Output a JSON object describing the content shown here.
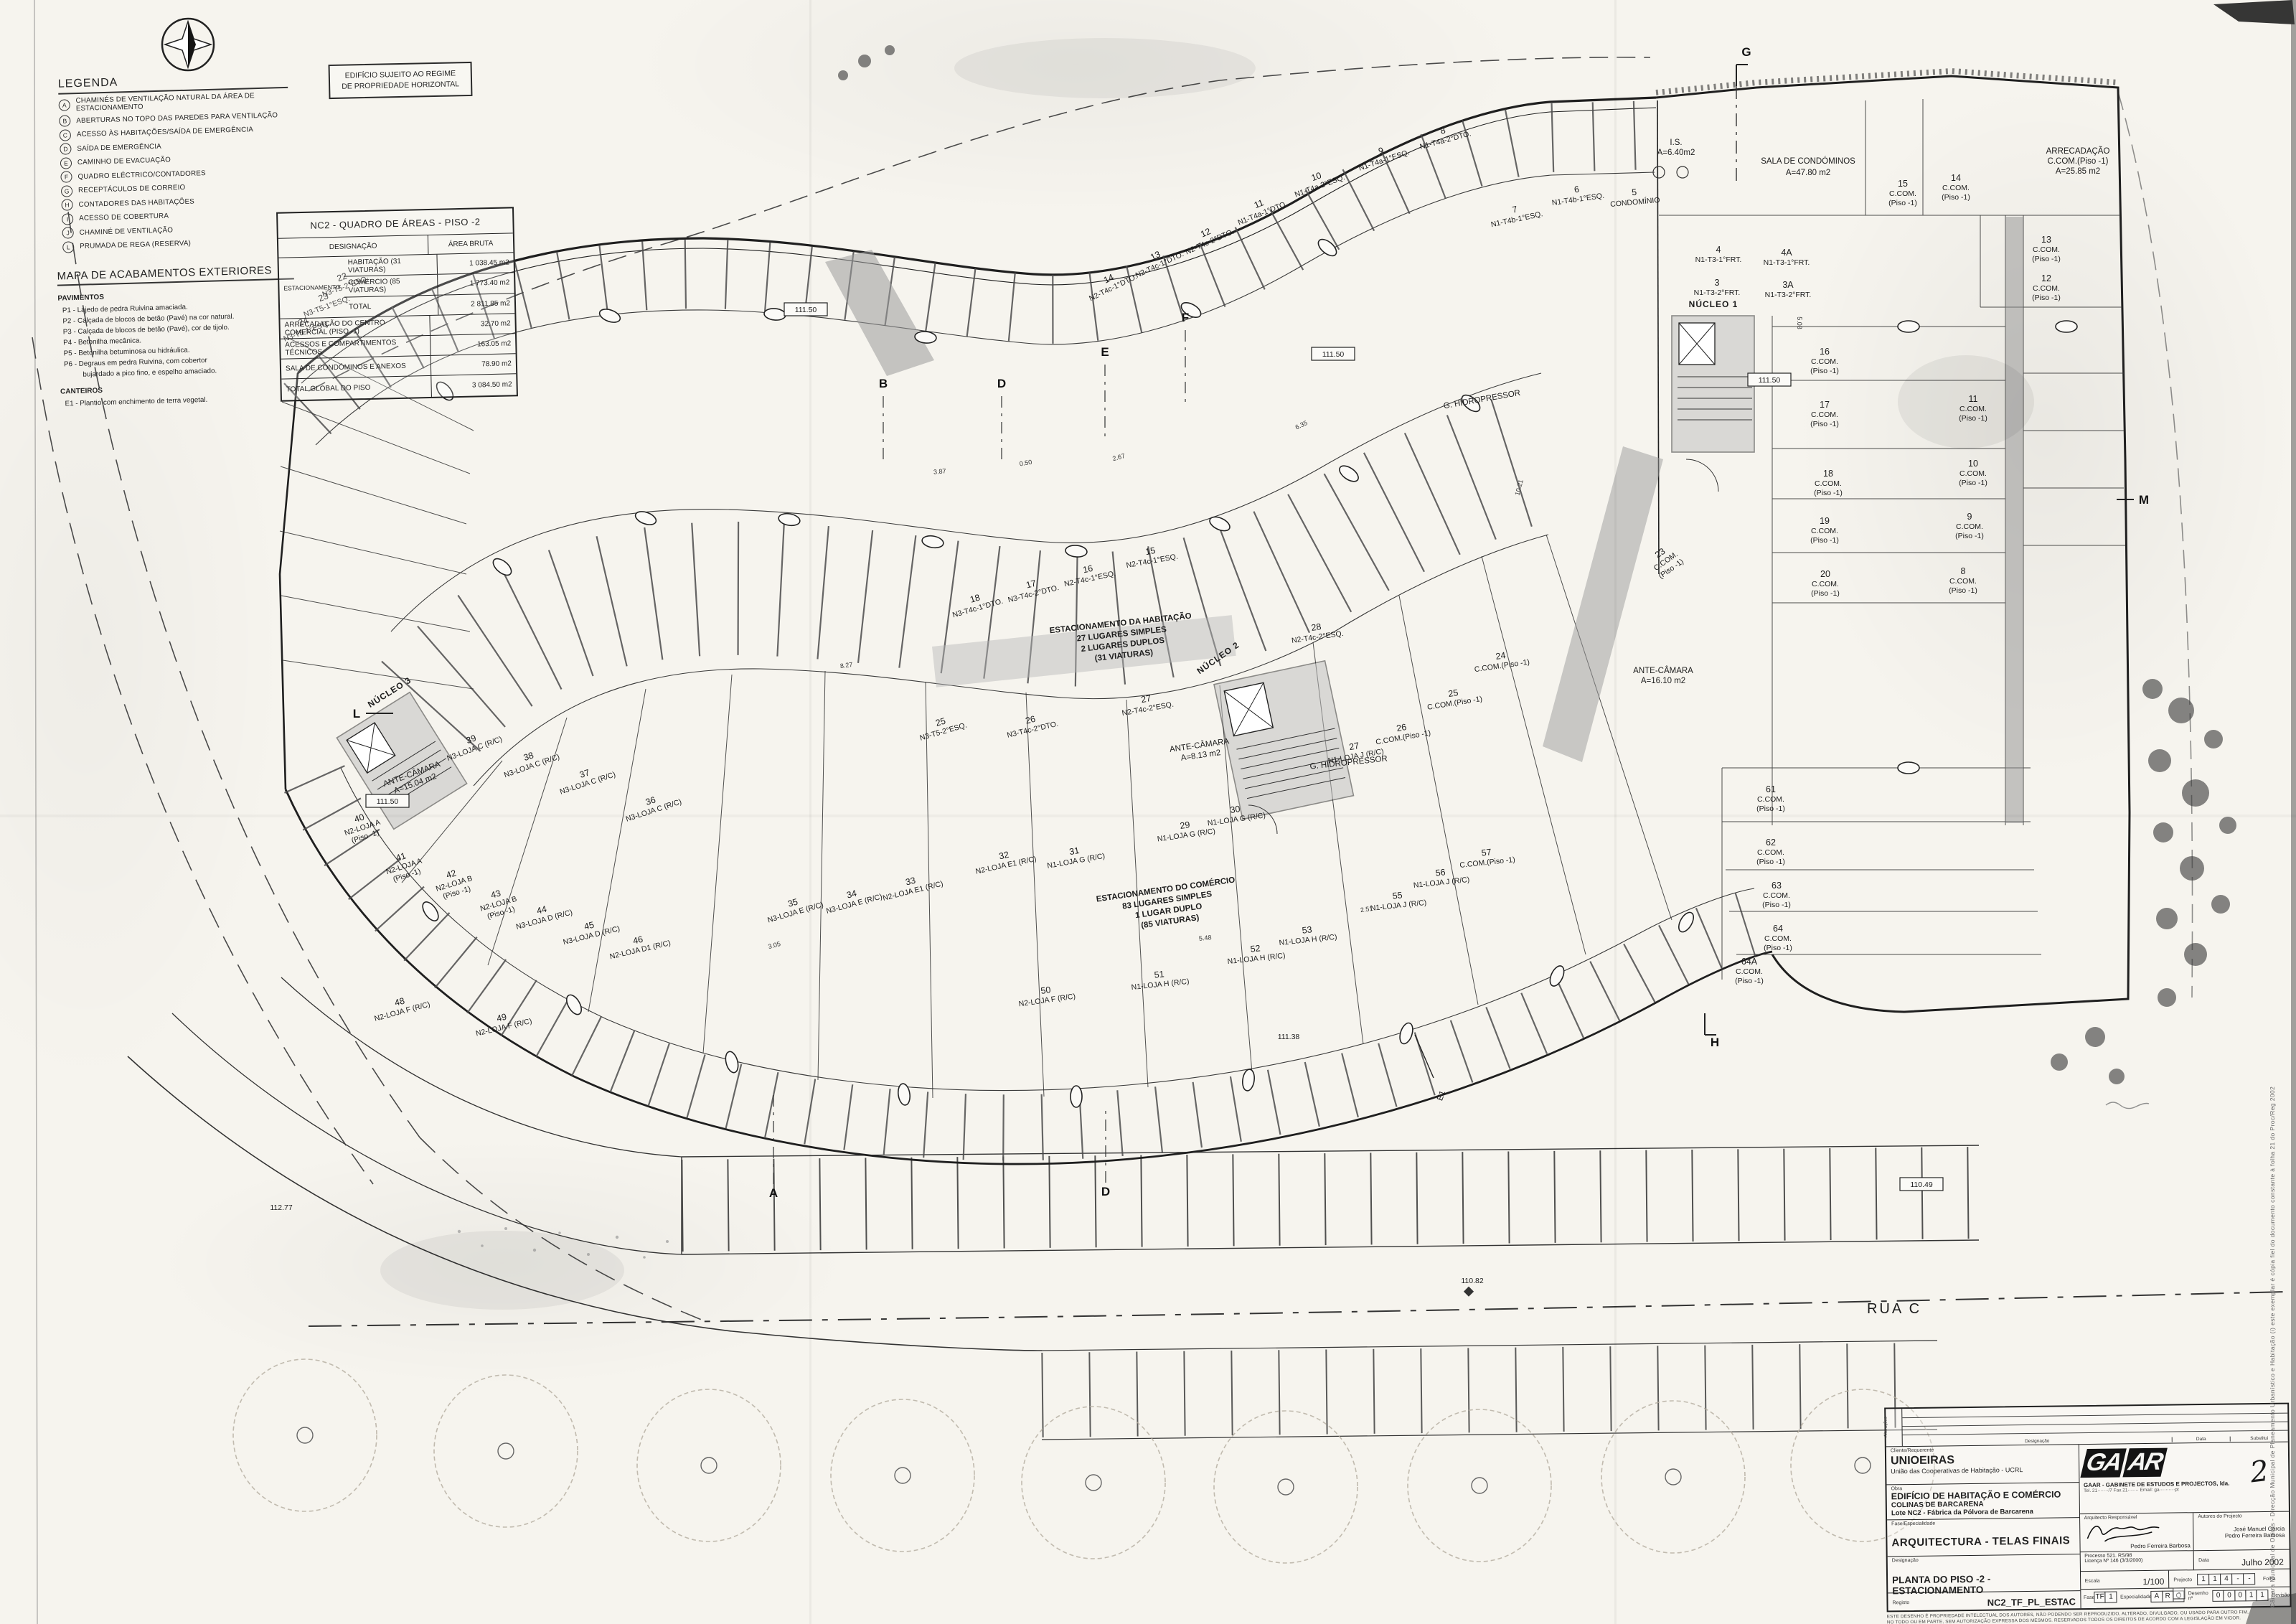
{
  "legend": {
    "title": "LEGENDA",
    "items": [
      {
        "k": "A",
        "t": "CHAMINÉS DE VENTILAÇÃO NATURAL DA ÁREA DE ESTACIONAMENTO"
      },
      {
        "k": "B",
        "t": "ABERTURAS NO TOPO DAS PAREDES PARA VENTILAÇÃO"
      },
      {
        "k": "C",
        "t": "ACESSO ÀS HABITAÇÕES/SAÍDA DE EMERGÊNCIA"
      },
      {
        "k": "D",
        "t": "SAÍDA DE EMERGÊNCIA"
      },
      {
        "k": "E",
        "t": "CAMINHO DE EVACUAÇÃO"
      },
      {
        "k": "F",
        "t": "QUADRO ELÉCTRICO/CONTADORES"
      },
      {
        "k": "G",
        "t": "RECEPTÁCULOS DE CORREIO"
      },
      {
        "k": "H",
        "t": "CONTADORES DAS HABITAÇÕES"
      },
      {
        "k": "I",
        "t": "ACESSO DE COBERTURA"
      },
      {
        "k": "J",
        "t": "CHAMINÉ DE VENTILAÇÃO"
      },
      {
        "k": "L",
        "t": "PRUMADA DE REGA (RESERVA)"
      }
    ]
  },
  "finishes": {
    "title": "MAPA DE ACABAMENTOS EXTERIORES",
    "s1": "PAVIMENTOS",
    "p": [
      "P1 - Lajedo de pedra Ruivina amaciada.",
      "P2 - Calçada de blocos de betão (Pavé) na cor natural.",
      "P3 - Calçada de blocos de betão (Pavé), cor de tijolo.",
      "P4 - Betonilha mecânica.",
      "P5 - Betonilha betuminosa ou hidráulica.",
      "P6 - Degraus em pedra Ruivina, com cobertor",
      "bujardado a pico fino, e espelho amaciado."
    ],
    "s2": "CANTEIROS",
    "c": "E1 - Plantio com enchimento de terra vegetal."
  },
  "notice": {
    "l1": "EDIFÍCIO SUJEITO AO REGIME",
    "l2": "DE PROPRIEDADE HORIZONTAL"
  },
  "areas": {
    "title": "NC2 - QUADRO DE ÁREAS - PISO -2",
    "h1": "DESIGNAÇÃO",
    "h2": "ÁREA BRUTA",
    "group": "ESTACIONAMENTO",
    "g_rows": [
      {
        "d": "HABITAÇÃO (31 VIATURAS)",
        "a": "1 038.45 m2"
      },
      {
        "d": "COMÉRCIO (85 VIATURAS)",
        "a": "1 773.40 m2"
      },
      {
        "d": "TOTAL",
        "a": "2 811.85 m2"
      }
    ],
    "rows": [
      {
        "d": "ARRECADAÇÃO DO CENTRO COMERCIAL (PISO -1)",
        "a": "32.70 m2"
      },
      {
        "d": "ACESSOS E COMPARTIMENTOS TÉCNICOS",
        "a": "163.05 m2"
      },
      {
        "d": "SALA DE CONDÓMINOS E ANEXOS",
        "a": "78.90 m2"
      },
      {
        "d": "TOTAL GLOBAL DO PISO",
        "a": "3 084.50 m2"
      }
    ]
  },
  "plan": {
    "street": "RUA C",
    "zone_hab": [
      "ESTACIONAMENTO DA HABITAÇÃO",
      "27 LUGARES SIMPLES",
      "2 LUGARES DUPLOS",
      "(31 VIATURAS)"
    ],
    "zone_com": [
      "ESTACIONAMENTO DO COMÉRCIO",
      "83 LUGARES SIMPLES",
      "1 LUGAR DUPLO",
      "(85 VIATURAS)"
    ],
    "grid": {
      "g": "G",
      "b": "B",
      "d1": "D",
      "e": "E",
      "f": "F",
      "a": "A",
      "d2": "D",
      "h": "H",
      "l": "L",
      "m": "M"
    },
    "ann": {
      "sala1": "SALA DE CONDÓMINOS",
      "sala2": "A=47.80 m2",
      "arr1": "ARRECADAÇÃO",
      "arr2": "C.COM.(Piso -1)",
      "arr3": "A=25.85 m2",
      "is1": "I.S.",
      "is2": "A=6.40m2",
      "ac1a": "ANTE-CÂMARA",
      "ac1b": "A=8.13 m2",
      "ac2a": "ANTE-CÂMARA",
      "ac2b": "A=16.10 m2",
      "ac3a": "ANTE-CÂMARA",
      "ac3b": "A=15.04 m2",
      "hidro": "G. HIDROPRESSOR",
      "nucleo1": "NÚCLEO 1",
      "nucleo2": "NÚCLEO 2",
      "nucleo3": "NÚCLEO 3",
      "e1": "E1",
      "condominio": "CONDOMÍNIO"
    },
    "levels": {
      "l1": "111.50",
      "l2": "110.82",
      "l3": "111.38",
      "l4": "110.49",
      "l5": "112.77"
    },
    "dims": [
      "2.67",
      "3.87",
      "0.50",
      "6.35",
      "8.27",
      "5.48",
      "2.51",
      "3.05",
      "10.21",
      "5.08"
    ],
    "stalls": [
      {
        "num": "3",
        "label": "N1-T3-2°FRT.",
        "sub": ""
      },
      {
        "num": "3A",
        "label": "N1-T3-2°FRT.",
        "sub": ""
      },
      {
        "num": "4",
        "label": "N1-T3-1°FRT.",
        "sub": ""
      },
      {
        "num": "4A",
        "label": "N1-T3-1°FRT.",
        "sub": ""
      },
      {
        "num": "5",
        "label": "CONDOMÍNIO",
        "sub": ""
      },
      {
        "num": "6",
        "label": "N1-T4b-1°ESQ.",
        "sub": ""
      },
      {
        "num": "7",
        "label": "N1-T4b-1°ESQ.",
        "sub": ""
      },
      {
        "num": "8",
        "label": "N1-T4a-2°DTO.",
        "sub": ""
      },
      {
        "num": "9",
        "label": "N1-T4a-1°ESQ.",
        "sub": ""
      },
      {
        "num": "10",
        "label": "N1-T4a-2°ESQ.",
        "sub": ""
      },
      {
        "num": "11",
        "label": "N1-T4a-1°DTO.",
        "sub": ""
      },
      {
        "num": "12",
        "label": "N2-T4c-2°DTO.",
        "sub": ""
      },
      {
        "num": "13",
        "label": "N2-T4c-1°DTO.",
        "sub": ""
      },
      {
        "num": "14",
        "label": "N2-T4c-1°DTO.",
        "sub": ""
      },
      {
        "num": "15",
        "label": "N2-T4c-1°ESQ.",
        "sub": ""
      },
      {
        "num": "16",
        "label": "N2-T4c-1°ESQ.",
        "sub": ""
      },
      {
        "num": "17",
        "label": "N3-T4c-2°DTO.",
        "sub": ""
      },
      {
        "num": "18",
        "label": "N3-T4c-1°DTO.",
        "sub": ""
      },
      {
        "num": "22",
        "label": "N3-T5-2°ESQ.",
        "sub": ""
      },
      {
        "num": "23",
        "label": "N3-T5-1°ESQ.",
        "sub": ""
      },
      {
        "num": "24",
        "label": "N3-T5-1°ESQ.",
        "sub": ""
      },
      {
        "num": "25",
        "label": "N3-T5-2°ESQ.",
        "sub": ""
      },
      {
        "num": "26",
        "label": "N3-T4c-2°DTO.",
        "sub": ""
      },
      {
        "num": "27",
        "label": "N2-T4c-2°ESQ.",
        "sub": ""
      },
      {
        "num": "28",
        "label": "N2-T4c-2°ESQ.",
        "sub": ""
      },
      {
        "num": "29",
        "label": "N1-LOJA G (R/C)",
        "sub": ""
      },
      {
        "num": "30",
        "label": "N1-LOJA G (R/C)",
        "sub": ""
      },
      {
        "num": "31",
        "label": "N1-LOJA G (R/C)",
        "sub": ""
      },
      {
        "num": "32",
        "label": "N2-LOJA E1 (R/C)",
        "sub": ""
      },
      {
        "num": "33",
        "label": "N2-LOJA E1 (R/C)",
        "sub": ""
      },
      {
        "num": "34",
        "label": "N3-LOJA E (R/C)",
        "sub": ""
      },
      {
        "num": "35",
        "label": "N3-LOJA E (R/C)",
        "sub": ""
      },
      {
        "num": "36",
        "label": "N3-LOJA C (R/C)",
        "sub": ""
      },
      {
        "num": "37",
        "label": "N3-LOJA C (R/C)",
        "sub": ""
      },
      {
        "num": "38",
        "label": "N3-LOJA C (R/C)",
        "sub": ""
      },
      {
        "num": "39",
        "label": "N3-LOJA C (R/C)",
        "sub": ""
      },
      {
        "num": "40",
        "label": "N2-LOJA A",
        "sub": "(Piso -1)"
      },
      {
        "num": "41",
        "label": "N2-LOJA A",
        "sub": "(Piso -1)"
      },
      {
        "num": "42",
        "label": "N2-LOJA B",
        "sub": "(Piso -1)"
      },
      {
        "num": "43",
        "label": "N2-LOJA B",
        "sub": "(Piso -1)"
      },
      {
        "num": "44",
        "label": "N3-LOJA D (R/C)",
        "sub": ""
      },
      {
        "num": "45",
        "label": "N3-LOJA D (R/C)",
        "sub": ""
      },
      {
        "num": "46",
        "label": "N2-LOJA D1 (R/C)",
        "sub": ""
      },
      {
        "num": "48",
        "label": "N2-LOJA F (R/C)",
        "sub": ""
      },
      {
        "num": "49",
        "label": "N2-LOJA F (R/C)",
        "sub": ""
      },
      {
        "num": "50",
        "label": "N2-LOJA F (R/C)",
        "sub": ""
      },
      {
        "num": "51",
        "label": "N1-LOJA H (R/C)",
        "sub": ""
      },
      {
        "num": "52",
        "label": "N1-LOJA H (R/C)",
        "sub": ""
      },
      {
        "num": "53",
        "label": "N1-LOJA H (R/C)",
        "sub": ""
      },
      {
        "num": "55",
        "label": "N1-LOJA J (R/C)",
        "sub": ""
      },
      {
        "num": "56",
        "label": "N1-LOJA J (R/C)",
        "sub": ""
      },
      {
        "num": "57",
        "label": "C.COM.(Piso -1)",
        "sub": ""
      },
      {
        "num": "24",
        "label": "C.COM.(Piso -1)",
        "sub": ""
      },
      {
        "num": "25",
        "label": "C.COM.(Piso -1)",
        "sub": ""
      },
      {
        "num": "26",
        "label": "C.COM.(Piso -1)",
        "sub": ""
      },
      {
        "num": "27",
        "label": "N1-LOJA J (R/C)",
        "sub": ""
      },
      {
        "num": "8",
        "label": "C.COM.",
        "sub": "(Piso -1)"
      },
      {
        "num": "9",
        "label": "C.COM.",
        "sub": "(Piso -1)"
      },
      {
        "num": "10",
        "label": "C.COM.",
        "sub": "(Piso -1)"
      },
      {
        "num": "11",
        "label": "C.COM.",
        "sub": "(Piso -1)"
      },
      {
        "num": "12",
        "label": "C.COM.",
        "sub": "(Piso -1)"
      },
      {
        "num": "13",
        "label": "C.COM.",
        "sub": "(Piso -1)"
      },
      {
        "num": "14",
        "label": "C.COM.",
        "sub": "(Piso -1)"
      },
      {
        "num": "15",
        "label": "C.COM.",
        "sub": "(Piso -1)"
      },
      {
        "num": "16",
        "label": "C.COM.",
        "sub": "(Piso -1)"
      },
      {
        "num": "17",
        "label": "C.COM.",
        "sub": "(Piso -1)"
      },
      {
        "num": "18",
        "label": "C.COM.",
        "sub": "(Piso -1)"
      },
      {
        "num": "19",
        "label": "C.COM.",
        "sub": "(Piso -1)"
      },
      {
        "num": "20",
        "label": "C.COM.",
        "sub": "(Piso -1)"
      },
      {
        "num": "23",
        "label": "C.COM.",
        "sub": "(Piso -1)"
      },
      {
        "num": "61",
        "label": "C.COM.",
        "sub": "(Piso -1)"
      },
      {
        "num": "62",
        "label": "C.COM.",
        "sub": "(Piso -1)"
      },
      {
        "num": "63",
        "label": "C.COM.",
        "sub": "(Piso -1)"
      },
      {
        "num": "64",
        "label": "C.COM.",
        "sub": "(Piso -1)"
      },
      {
        "num": "64A",
        "label": "C.COM.",
        "sub": "(Piso -1)"
      }
    ]
  },
  "tb": {
    "rev": {
      "alteracoes": "Alterações",
      "revisao": "Revisão",
      "designacao": "Designação",
      "data": "Data",
      "substitui": "Substitui"
    },
    "client_label": "Cliente/Requerente",
    "client_name": "UNIOEIRAS",
    "client_sub": "União das Cooperativas de Habitação - UCRL",
    "obra_label": "Obra",
    "obra1": "EDIFÍCIO DE HABITAÇÃO E COMÉRCIO",
    "obra2": "COLINAS DE BARCARENA",
    "obra3": "Lote NC2 - Fábrica da Pólvora de Barcarena",
    "fase_label": "Fase/Especialidade",
    "fase_value": "ARQUITECTURA - TELAS FINAIS",
    "desig_label": "Designação",
    "desig_value": "PLANTA DO PISO -2 - ESTACIONAMENTO",
    "registo_label": "Registo",
    "registo_value": "NC2_TF_PL_ESTAC",
    "logo1": "GA",
    "logo2": "AR",
    "sheet_number": "2",
    "firm_name": "GAAR - GABINETE DE ESTUDOS E PROJECTOS, lda.",
    "firm_addr": "Tel. 21·······/7  Fax 21·······  Email: ga··········pt",
    "arch_label": "Arquitecto Responsável",
    "arch_name": "Pedro Ferreira Barbosa",
    "authors_label": "Autores do Projecto",
    "author1": "José Manuel Garcia",
    "author2": "Pedro Ferreira Barbosa",
    "processo": "Processo 521. RS/98",
    "licenca": "Licença Nº 146 (3/3/2000)",
    "data_label": "Data",
    "data_value": "Julho 2002",
    "escala_label": "Escala",
    "escala_value": "1/100",
    "projecto_label": "Projecto",
    "projecto_boxes": [
      "1",
      "1",
      "4",
      "-",
      "-"
    ],
    "folha_label": "Folha",
    "folha_box": "-",
    "fase_box_label": "Fase",
    "verif_label": "Verif.",
    "fase_boxes": [
      "TF",
      "1"
    ],
    "espec_label": "Especialidade",
    "espec_boxes": [
      "A",
      "R",
      "Q"
    ],
    "desenho_label": "Desenho nº",
    "desenho_boxes": [
      "0",
      "0",
      "0",
      "1",
      "1"
    ],
    "rev_label": "Revisão",
    "disc1": "ESTE DESENHO É PROPRIEDADE INTELECTUAL DOS AUTORES, NÃO PODENDO SER REPRODUZIDO, ALTERADO, DIVULGADO, OU USADO PARA OUTRO FIM,",
    "disc2": "NO TODO OU EM PARTE, SEM AUTORIZAÇÃO EXPRESSA DOS MESMOS. RESERVADOS TODOS OS DIREITOS DE ACORDO COM A LEGISLAÇÃO EM VIGOR."
  },
  "stamp": "Câmara Municipal de Oeiras - Direcção Municipal de Planeamento Urbanístico e Habitação   (i) este exemplar é cópia fiel do documento constante à folha 21 do Proc/Reg   2002"
}
